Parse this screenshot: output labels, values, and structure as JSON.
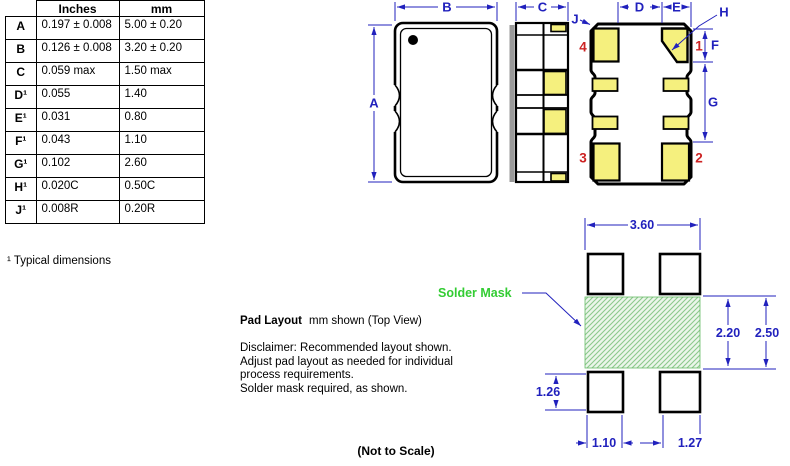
{
  "dimension_table": {
    "headers": [
      "Inches",
      "mm"
    ],
    "rows": [
      {
        "label": "A",
        "inches": "0.197 ± 0.008",
        "mm": "5.00 ± 0.20"
      },
      {
        "label": "B",
        "inches": "0.126 ± 0.008",
        "mm": "3.20 ± 0.20"
      },
      {
        "label": "C",
        "inches": "0.059 max",
        "mm": "1.50 max"
      },
      {
        "label": "D¹",
        "inches": "0.055",
        "mm": "1.40"
      },
      {
        "label": "E¹",
        "inches": "0.031",
        "mm": "0.80"
      },
      {
        "label": "F¹",
        "inches": "0.043",
        "mm": "1.10"
      },
      {
        "label": "G¹",
        "inches": "0.102",
        "mm": "2.60"
      },
      {
        "label": "H¹",
        "inches": "0.020C",
        "mm": "0.50C"
      },
      {
        "label": "J¹",
        "inches": "0.008R",
        "mm": "0.20R"
      }
    ],
    "footnote": "¹ Typical dimensions"
  },
  "drawing": {
    "dim_letters": {
      "A": "A",
      "B": "B",
      "C": "C",
      "D": "D",
      "E": "E",
      "F": "F",
      "G": "G",
      "H": "H",
      "J": "J"
    },
    "pins": {
      "p1": "1",
      "p2": "2",
      "p3": "3",
      "p4": "4"
    }
  },
  "pad_layout": {
    "heading_bold": "Pad Layout",
    "heading_rest": "mm shown (Top View)",
    "solder_mask": "Solder Mask",
    "disclaimer": [
      "Disclaimer: Recommended layout shown.",
      "Adjust pad layout as needed for individual",
      "process requirements.",
      "Solder mask required, as shown."
    ],
    "dims": {
      "width": "3.60",
      "mask_height": "2.20",
      "pad_span": "2.50",
      "pad_height": "1.26",
      "pad_w_left": "1.10",
      "pad_w_right": "1.27"
    },
    "not_to_scale": "(Not to Scale)"
  },
  "colors": {
    "dimension_blue": "#2121BD",
    "pin_red": "#CC2222",
    "pad_yellow": "#F5F07E",
    "solder_mask_green": "#33CC33",
    "hatch_line_green": "#8CC98C",
    "hatch_bg_green": "#EBF6EA"
  }
}
